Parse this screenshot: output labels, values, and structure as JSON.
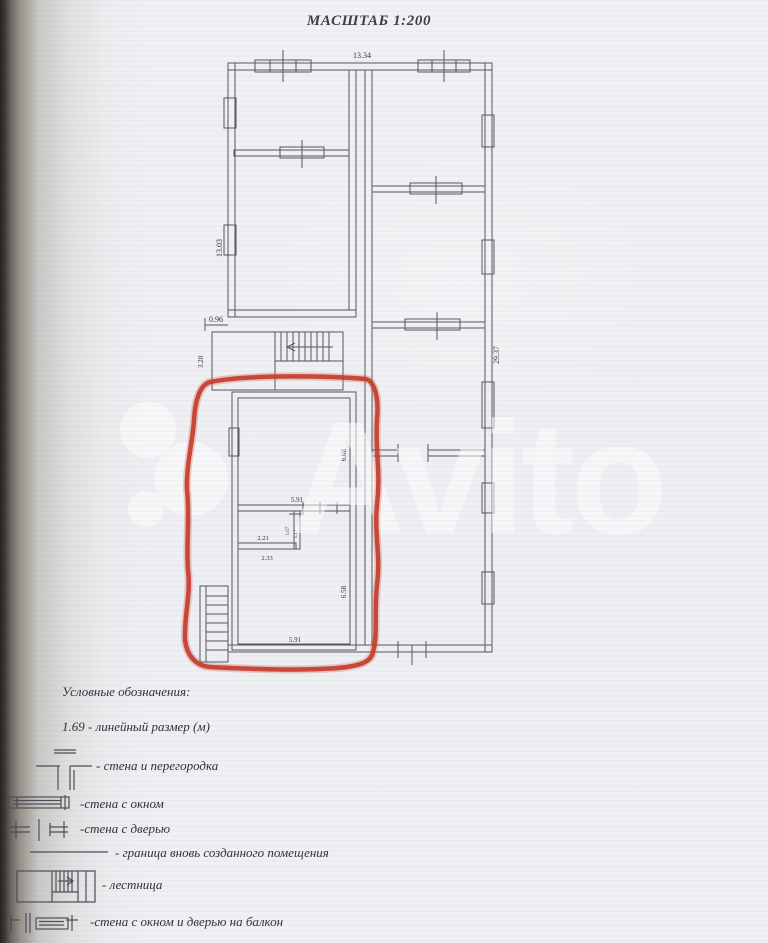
{
  "title": "МАСШТАБ 1:200",
  "watermark": {
    "brand": "Avito"
  },
  "plan": {
    "dimensions": {
      "width_top": "13.34",
      "height_left": "13.03",
      "step_left": "0.96",
      "vestibule_depth": "3.20",
      "height_right": "29.37",
      "room_upper_height": "6.08",
      "partition_width": "5.91",
      "closet_width_top": "2.21",
      "closet_width_bottom": "2.33",
      "closet_height_1": "1.07",
      "closet_height_2": "1.17",
      "room_lower_height": "6.58",
      "room_width_bottom": "5.91"
    }
  },
  "legend": {
    "heading": "Условные обозначения:",
    "items": [
      {
        "symbol": "linear-dimension",
        "label": "1.69 -  линейный размер (м)"
      },
      {
        "symbol": "wall-and-partition",
        "label": "- стена и перегородка"
      },
      {
        "symbol": "wall-with-window",
        "label": "-стена с  окном"
      },
      {
        "symbol": "wall-with-door",
        "label": "-стена с дверью"
      },
      {
        "symbol": "new-room-boundary",
        "label": "- граница вновь созданного помещения"
      },
      {
        "symbol": "staircase",
        "label": "- лестница"
      },
      {
        "symbol": "wall-window-balcony-door",
        "label": "-стена с окном и дверью на балкон"
      }
    ]
  },
  "colors": {
    "annotation_red": "#c5382a",
    "plan_line": "#56565f",
    "paper": "#eef0f3"
  }
}
